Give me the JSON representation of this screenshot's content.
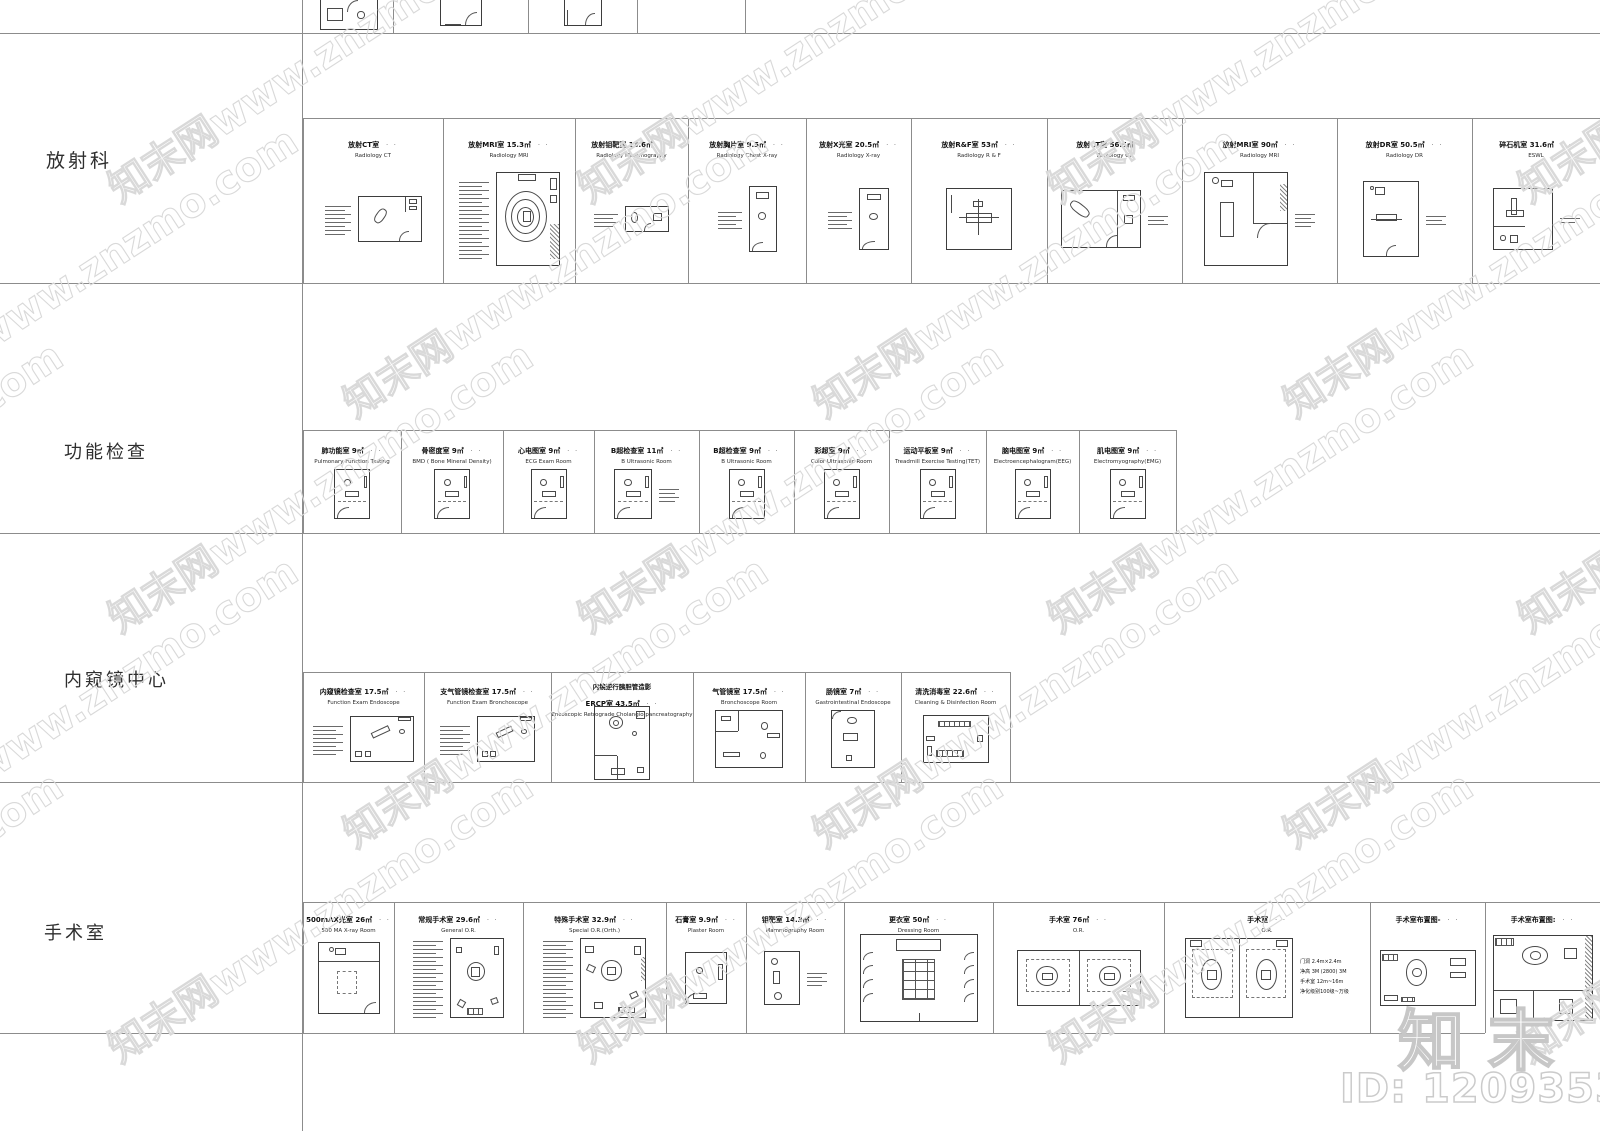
{
  "page": {
    "width": 1600,
    "height": 1131,
    "background": "#ffffff",
    "line_color": "#8c8c8c"
  },
  "watermark": {
    "tile_text": "知末网www.znzmo.com",
    "brand_text": "知末",
    "id_text": "ID: 1209353017"
  },
  "marks": {
    "title_mark": "· ·"
  },
  "labels_column": {
    "separator_x": 302
  },
  "grid": {
    "hlines": [
      {
        "y": 33,
        "x0": 0,
        "x1": 1600
      },
      {
        "y": 283,
        "x0": 0,
        "x1": 1600
      },
      {
        "y": 533,
        "x0": 0,
        "x1": 1600
      },
      {
        "y": 782,
        "x0": 0,
        "x1": 1600
      },
      {
        "y": 1033,
        "x0": 0,
        "x1": 1485
      }
    ],
    "vlines": [
      {
        "x": 302,
        "y0": 0,
        "y1": 1131
      }
    ]
  },
  "top_strip": {
    "bounds": [
      393,
      528,
      637,
      745
    ],
    "cells": [
      {
        "x": 305,
        "w": 88,
        "plan": {
          "k": "p1",
          "w": 58,
          "h": 30
        }
      },
      {
        "x": 393,
        "w": 135,
        "plan": {
          "k": "p2",
          "w": 42,
          "h": 26
        }
      },
      {
        "x": 528,
        "w": 109,
        "plan": {
          "k": "p3",
          "w": 38,
          "h": 26
        }
      }
    ]
  },
  "rows": [
    {
      "label": "放射科",
      "label_x": 46,
      "label_y": 146,
      "label_size": 19,
      "strip_top": 118,
      "band_bottom": 283,
      "title_pad": 16,
      "body_top": 40,
      "bounds": [
        303,
        443,
        575,
        688,
        806,
        911,
        1047,
        1182,
        1337,
        1472,
        1600
      ],
      "cells": [
        {
          "title": "放射CT室",
          "en": "Radiology CT",
          "legend": 8,
          "lw": 26,
          "plan": {
            "k": "ct1",
            "w": 64,
            "h": 46
          }
        },
        {
          "title": "放射MRI室 15.3㎡",
          "en": "Radiology MRI",
          "legend": 20,
          "lw": 30,
          "plan": {
            "k": "mri",
            "w": 64,
            "h": 94
          }
        },
        {
          "title": "放射钼靶室 13.6㎡",
          "en": "Radiology Mammography",
          "legend": 4,
          "lw": 24,
          "plan": {
            "k": "mam",
            "w": 44,
            "h": 26
          }
        },
        {
          "title": "放射胸片室 9.5㎡",
          "en": "Radiology Chest X-ray",
          "legend": 5,
          "lw": 24,
          "plan": {
            "k": "chest",
            "w": 28,
            "h": 66
          }
        },
        {
          "title": "放射X光室 20.5㎡",
          "en": "Radiology X-ray",
          "legend": 5,
          "lw": 24,
          "plan": {
            "k": "chest",
            "w": 30,
            "h": 62
          }
        },
        {
          "title": "放射R&F室 53㎡",
          "en": "Radiology R & F",
          "plan": {
            "k": "rf",
            "w": 66,
            "h": 62
          }
        },
        {
          "title": "放射CT室 56.5㎡",
          "en": "Radiology CT",
          "plan": {
            "k": "ct2",
            "w": 80,
            "h": 58
          },
          "notes": 3
        },
        {
          "title": "放射MRI室 90㎡",
          "en": "Radiology MRI",
          "plan": {
            "k": "mri2",
            "w": 84,
            "h": 94
          },
          "notes": 4
        },
        {
          "title": "放射DR室 50.5㎡",
          "en": "Radiology DR",
          "plan": {
            "k": "dr",
            "w": 56,
            "h": 76
          },
          "notes": 3
        },
        {
          "title": "碎石机室 31.6㎡",
          "en": "ESWL",
          "plan": {
            "k": "eswl",
            "w": 60,
            "h": 62
          },
          "notes": 2
        }
      ]
    },
    {
      "label": "功能检查",
      "label_x": 64,
      "label_y": 438,
      "label_size": 18,
      "strip_top": 430,
      "band_bottom": 533,
      "title_pad": 10,
      "body_top": 28,
      "bounds": [
        303,
        401,
        503,
        594,
        699,
        794,
        889,
        986,
        1079,
        1176
      ],
      "cells": [
        {
          "title": "肺功能室 9㎡",
          "en": "Pulmonary Function Testing",
          "plan": {
            "k": "exam",
            "w": 36,
            "h": 50
          }
        },
        {
          "title": "骨密度室 9㎡",
          "en": "BMD ( Bone Mineral Density)",
          "plan": {
            "k": "exam",
            "w": 36,
            "h": 50
          }
        },
        {
          "title": "心电图室 9㎡",
          "en": "ECG Exam Room",
          "plan": {
            "k": "exam",
            "w": 36,
            "h": 50
          }
        },
        {
          "title": "B超检查室 11㎡",
          "en": "B Ultrasonic Room",
          "plan": {
            "k": "exam",
            "w": 38,
            "h": 50
          },
          "notes": 4
        },
        {
          "title": "B超检查室 9㎡",
          "en": "B Ultrasonic Room",
          "plan": {
            "k": "exam",
            "w": 36,
            "h": 50
          }
        },
        {
          "title": "彩超室 9㎡",
          "en": "Color Ultrasonic Room",
          "plan": {
            "k": "exam",
            "w": 36,
            "h": 50
          }
        },
        {
          "title": "运动平板室 9㎡",
          "en": "Treadmill Exercise Testing(TET)",
          "plan": {
            "k": "exam",
            "w": 36,
            "h": 50
          }
        },
        {
          "title": "脑电图室 9㎡",
          "en": "Electroencephalogram(EEG)",
          "plan": {
            "k": "exam",
            "w": 36,
            "h": 50
          }
        },
        {
          "title": "肌电图室 9㎡",
          "en": "Electromyography(EMG)",
          "plan": {
            "k": "exam",
            "w": 36,
            "h": 50
          }
        }
      ]
    },
    {
      "label": "内窥镜中心",
      "label_x": 64,
      "label_y": 666,
      "label_size": 18,
      "strip_top": 672,
      "band_bottom": 782,
      "title_pad": 9,
      "body_top": 27,
      "bounds": [
        303,
        424,
        551,
        693,
        805,
        901,
        1010
      ],
      "cells": [
        {
          "title": "内窥镜检查室 17.5㎡",
          "en": "Function Exam Endoscope",
          "legend": 8,
          "lw": 30,
          "plan": {
            "k": "endo",
            "w": 64,
            "h": 46
          }
        },
        {
          "title": "支气管镜检查室 17.5㎡",
          "en": "Function Exam Bronchoscope",
          "legend": 8,
          "lw": 30,
          "plan": {
            "k": "endo",
            "w": 58,
            "h": 46
          }
        },
        {
          "pre": "内镜逆行胰胆管造影",
          "title": "ERCP室 43.5㎡",
          "en": "Encoscopic Retrograde Cholangio pancreatography",
          "plan": {
            "k": "ercp",
            "w": 56,
            "h": 74
          }
        },
        {
          "title": "气管镜室 17.5㎡",
          "en": "Bronchoscope Room",
          "plan": {
            "k": "bronch",
            "w": 68,
            "h": 58
          }
        },
        {
          "title": "肠镜室 7㎡",
          "en": "Gastrointestinal Endoscope",
          "plan": {
            "k": "gastro",
            "w": 44,
            "h": 58
          }
        },
        {
          "title": "清洗消毒室 22.6㎡",
          "en": "Cleaning & Disinfection Room",
          "plan": {
            "k": "clean",
            "w": 66,
            "h": 48
          }
        }
      ]
    },
    {
      "label": "手术室",
      "label_x": 44,
      "label_y": 919,
      "label_size": 18,
      "strip_top": 902,
      "band_bottom": 1033,
      "title_pad": 7,
      "body_top": 24,
      "bounds": [
        303,
        394,
        523,
        666,
        746,
        844,
        993,
        1164,
        1370,
        1485,
        1600
      ],
      "cells": [
        {
          "title": "500mAX光室 26㎡",
          "en": "500 MA X-ray Room",
          "plan": {
            "k": "xray500",
            "w": 62,
            "h": 72
          }
        },
        {
          "title": "常规手术室 29.6㎡",
          "en": "General O.R.",
          "legend": 20,
          "lw": 30,
          "plan": {
            "k": "orgen",
            "w": 54,
            "h": 80
          }
        },
        {
          "title": "特殊手术室 32.9㎡",
          "en": "Special O.R.(Orth.)",
          "legend": 20,
          "lw": 30,
          "plan": {
            "k": "orsp",
            "w": 66,
            "h": 80
          }
        },
        {
          "title": "石膏室 9.9㎡",
          "en": "Plaster Room",
          "plan": {
            "k": "plaster",
            "w": 42,
            "h": 52
          }
        },
        {
          "title": "钼靶室 14.3㎡",
          "en": "Mammography Room",
          "plan": {
            "k": "mammo",
            "w": 36,
            "h": 54
          },
          "notes": 4
        },
        {
          "title": "更衣室 50㎡",
          "en": "Dressing Room",
          "plan": {
            "k": "dressing",
            "w": 118,
            "h": 88
          }
        },
        {
          "title": "手术室 76㎡",
          "en": "O.R.",
          "plan": {
            "k": "or2",
            "w": 124,
            "h": 56
          }
        },
        {
          "title": "手术室",
          "en": "O.R.",
          "plan": {
            "k": "or2b",
            "w": 108,
            "h": 80
          },
          "tnotes": [
            "门洞 2.4m×2.4m",
            "净高 3M (2800) 3M",
            "手术室 12m~16m",
            "净化级别100级~万级"
          ]
        },
        {
          "title": "手术室布置图-",
          "plan": {
            "k": "orlay1",
            "w": 96,
            "h": 56
          }
        },
        {
          "title": "手术室布置图:",
          "plan": {
            "k": "orlay2",
            "w": 100,
            "h": 86
          }
        }
      ]
    }
  ]
}
